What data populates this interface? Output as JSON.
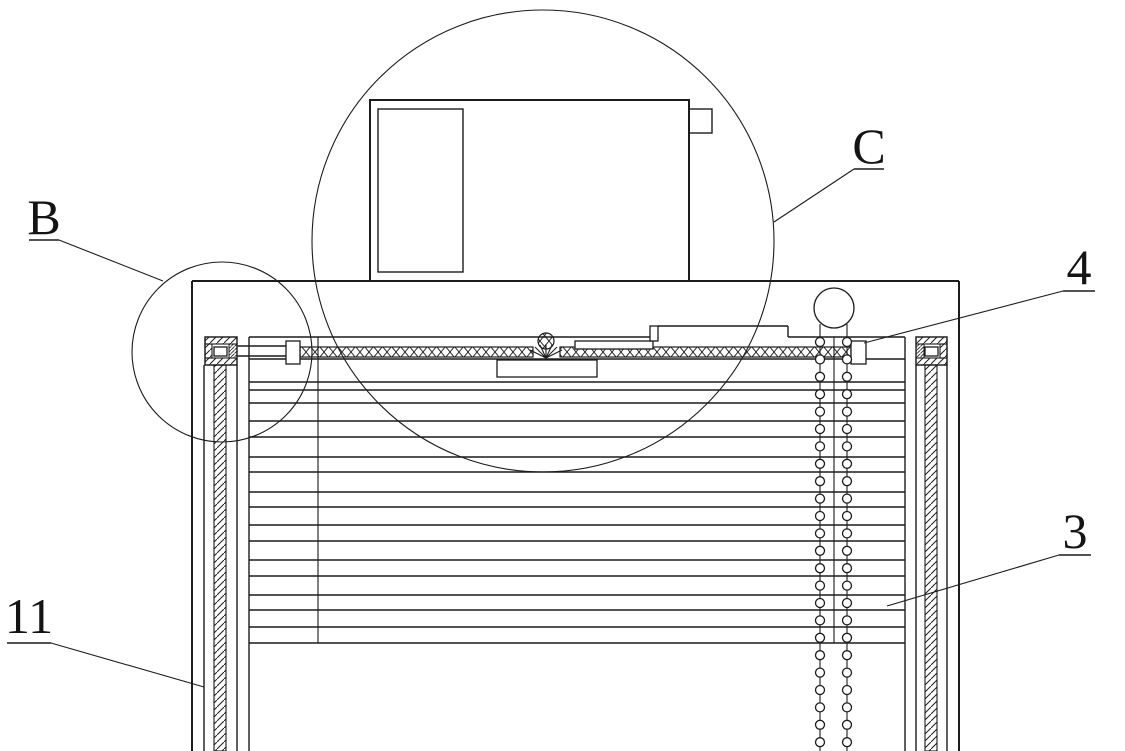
{
  "figure": {
    "title": "Patent-style sectional drawing: window with built-in venetian blind, top motor unit, side rails and bead-chain drive",
    "background_color": "#ffffff",
    "line_color": "#1c1c1c"
  },
  "callouts": [
    {
      "id": "B",
      "label": "B",
      "points_to": "left-bracket-detail-circle"
    },
    {
      "id": "C",
      "label": "C",
      "points_to": "motor-unit-detail-circle"
    },
    {
      "id": "4",
      "label": "4",
      "points_to": "right-end-block-of-crosshatched-bar"
    },
    {
      "id": "3",
      "label": "3",
      "points_to": "blind-slats"
    },
    {
      "id": "11",
      "label": "11",
      "points_to": "left-side-rail"
    }
  ],
  "diagram": {
    "frame": {
      "left_x": 192,
      "right_x": 959,
      "top_y": 281,
      "bottom_y": 751
    },
    "motor_box": {
      "x": 370,
      "y": 100,
      "w": 319,
      "h": 181,
      "inner": {
        "x": 378,
        "y": 109,
        "w": 85,
        "h": 163
      },
      "tab": {
        "x": 689,
        "y": 109,
        "w": 23,
        "h": 24
      }
    },
    "detail_circles": [
      {
        "id": "B",
        "cx": 222,
        "cy": 352,
        "r": 90
      },
      {
        "id": "C",
        "cx": 543,
        "cy": 241,
        "r": 231
      }
    ],
    "slats": {
      "x1": 249,
      "x2": 905,
      "y_positions": [
        382,
        390,
        403,
        421,
        437,
        457,
        472,
        492,
        507,
        525,
        541,
        560,
        576,
        595,
        610,
        627,
        643
      ]
    },
    "cords": {
      "x_positions": [
        318,
        834
      ],
      "y1": 337,
      "y2": 643
    },
    "pulley": {
      "cx": 834,
      "cy": 308,
      "r": 20
    },
    "chains": {
      "x_positions": [
        820,
        847
      ],
      "line_top_y": 324,
      "line_bottom_y": 751,
      "bead_radius": 4.5,
      "bead_start_y": 342,
      "bead_spacing": 17.4,
      "bead_end_y": 749
    }
  }
}
